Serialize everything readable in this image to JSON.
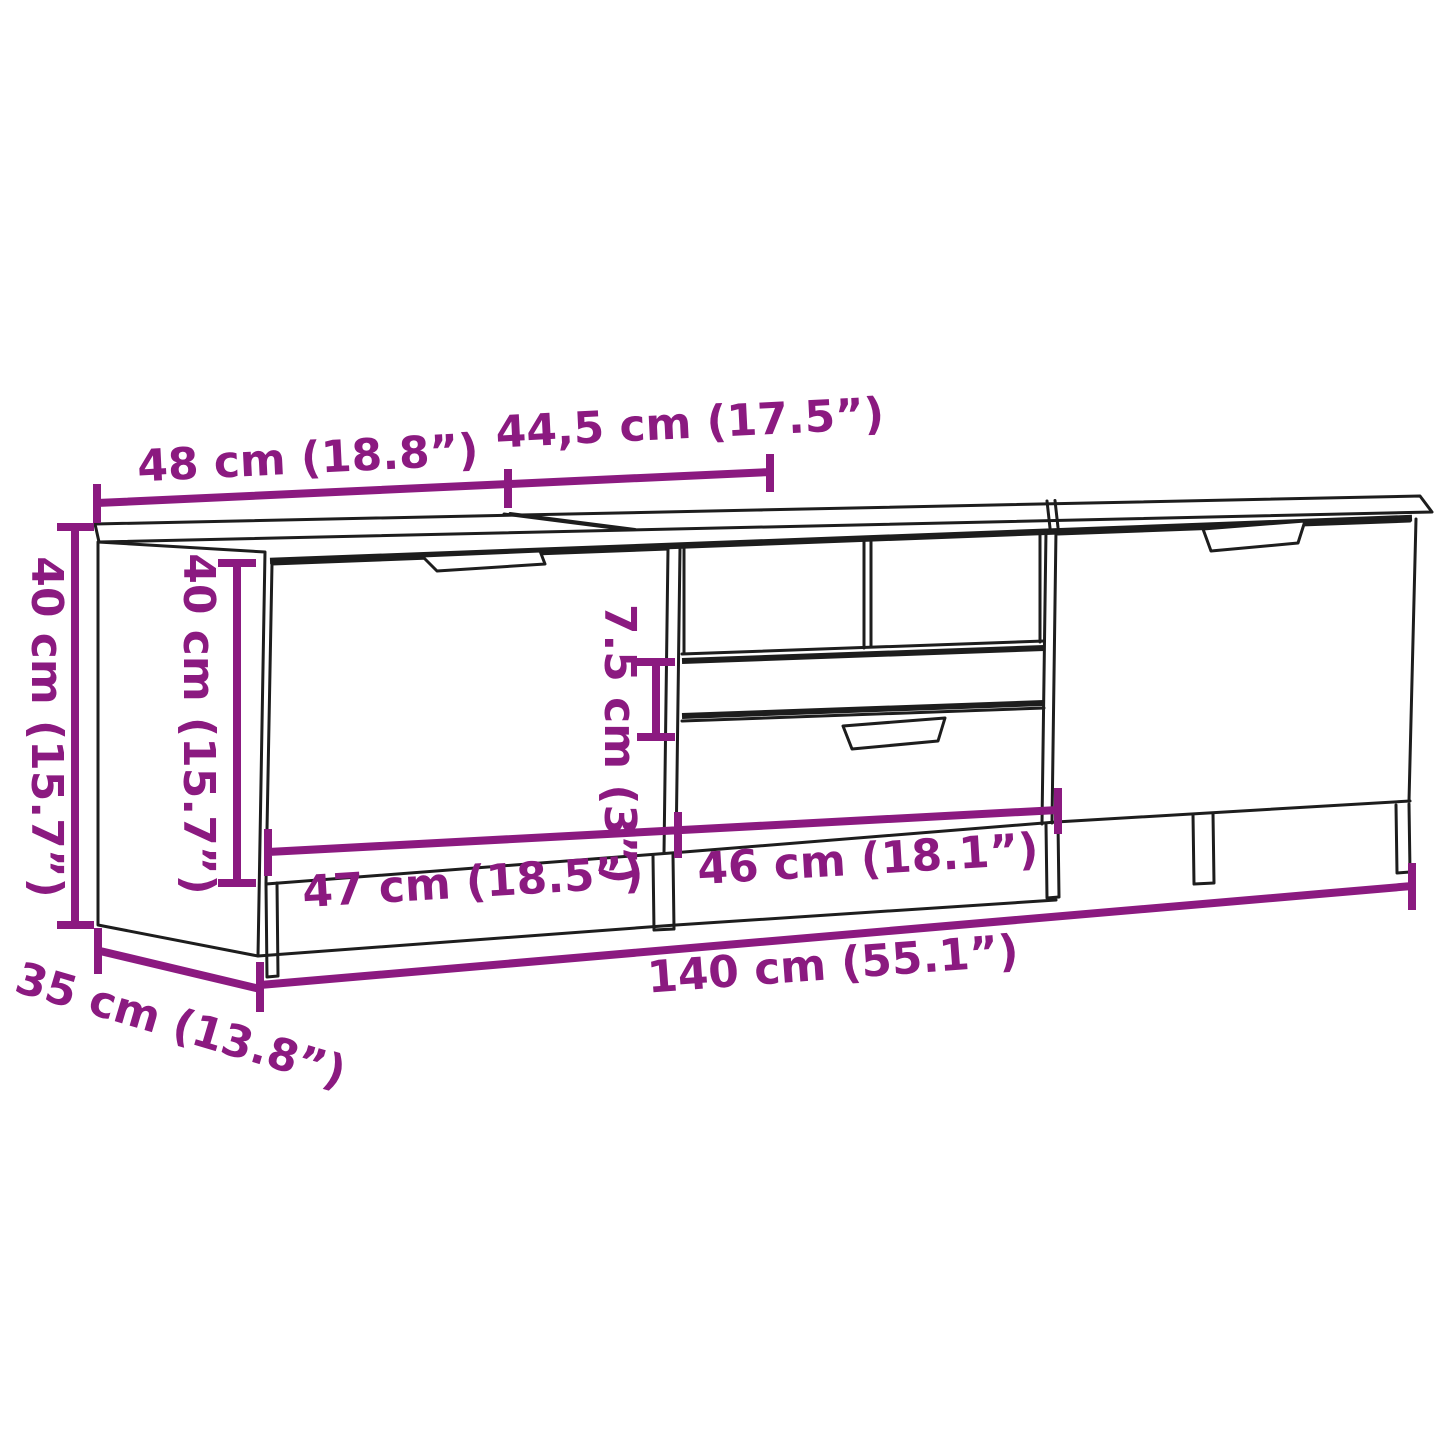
{
  "diagram": {
    "type": "furniture dimension line drawing",
    "subject": "TV cabinet / sideboard with left door, middle open shelf with two drawers, right door",
    "colors": {
      "dimension": "#8B1A80",
      "line": "#1d1d1d",
      "background": "#ffffff"
    },
    "dimensions": {
      "top_section_left": "48 cm (18.8”)",
      "top_section_middle": "44,5 cm (17.5”)",
      "overall_height": "40 cm (15.7”)",
      "door_height": "40 cm (15.7”)",
      "drawer_height": "7.5 cm (3”)",
      "left_compartment_width": "47 cm (18.5”)",
      "middle_compartment_width": "46 cm (18.1”)",
      "overall_width": "140 cm (55.1”)",
      "overall_depth": "35 cm (13.8”)"
    }
  }
}
